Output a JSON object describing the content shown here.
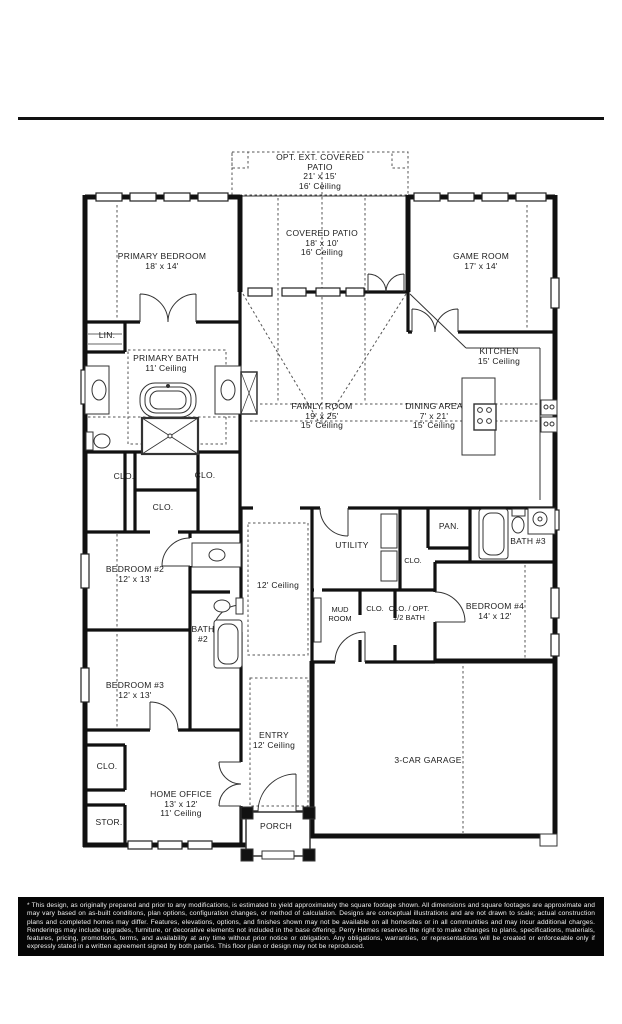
{
  "colors": {
    "wall": "#111111",
    "thin_line": "#333333",
    "dashed_line": "#555555",
    "disclaimer_bg": "#000000",
    "disclaimer_text": "#f2f2f2"
  },
  "plan": {
    "labels": {
      "opt_patio": {
        "lines": [
          "OPT. EXT. COVERED",
          "PATIO",
          "21' x 15'",
          "16' Ceiling"
        ]
      },
      "covered_patio": {
        "lines": [
          "COVERED PATIO",
          "18' x 10'",
          "16' Ceiling"
        ]
      },
      "primary_bedroom": {
        "lines": [
          "PRIMARY BEDROOM",
          "18' x 14'"
        ]
      },
      "game_room": {
        "lines": [
          "GAME ROOM",
          "17' x 14'"
        ]
      },
      "kitchen": {
        "lines": [
          "KITCHEN",
          "15' Ceiling"
        ]
      },
      "family_room": {
        "lines": [
          "FAMILY ROOM",
          "19' x 25'",
          "15' Ceiling"
        ]
      },
      "dining_area": {
        "lines": [
          "DINING AREA",
          "7' x 21'",
          "15' Ceiling"
        ]
      },
      "primary_bath": {
        "lines": [
          "PRIMARY BATH",
          "11' Ceiling"
        ]
      },
      "lin": {
        "lines": [
          "LIN."
        ]
      },
      "clo_a": {
        "lines": [
          "CLO."
        ]
      },
      "clo_b": {
        "lines": [
          "CLO."
        ]
      },
      "clo_c": {
        "lines": [
          "CLO."
        ]
      },
      "bedroom2": {
        "lines": [
          "BEDROOM #2",
          "12' x 13'"
        ]
      },
      "bath2": {
        "lines": [
          "BATH",
          "#2"
        ]
      },
      "bedroom3": {
        "lines": [
          "BEDROOM #3",
          "12' x 13'"
        ]
      },
      "hall_ceiling": {
        "lines": [
          "12' Ceiling"
        ]
      },
      "utility": {
        "lines": [
          "UTILITY"
        ]
      },
      "pan": {
        "lines": [
          "PAN."
        ]
      },
      "clo_d": {
        "lines": [
          "CLO."
        ]
      },
      "bath3": {
        "lines": [
          "BATH #3"
        ]
      },
      "mud_room": {
        "lines": [
          "MUD",
          "ROOM"
        ]
      },
      "clo_e": {
        "lines": [
          "CLO."
        ]
      },
      "clo_opt_bath": {
        "lines": [
          "CLO. / OPT.",
          "1/2 BATH"
        ]
      },
      "bedroom4": {
        "lines": [
          "BEDROOM #4",
          "14' x 12'"
        ]
      },
      "entry": {
        "lines": [
          "ENTRY",
          "12' Ceiling"
        ]
      },
      "garage": {
        "lines": [
          "3-CAR GARAGE"
        ]
      },
      "clo_f": {
        "lines": [
          "CLO."
        ]
      },
      "home_office": {
        "lines": [
          "HOME OFFICE",
          "13' x 12'",
          "11' Ceiling"
        ]
      },
      "stor": {
        "lines": [
          "STOR."
        ]
      },
      "porch": {
        "lines": [
          "PORCH"
        ]
      }
    }
  },
  "disclaimer": {
    "text": "* This design, as originally prepared and prior to any modifications, is estimated to  yield approximately the  square footage  shown.  All dimensions and  square footages are approximate and  may vary based  on as-built conditions,  plan options,  configuration changes,  or method of  calculation.  Designs are  conceptual  illustrations and  are not drawn to scale; actual construction plans and completed homes may differ.   Features,  elevations,  options,  and finishes shown may not be available on all homesites or in all communities and may incur additional charges.   Renderings may include upgrades, furniture, or decorative elements not included in the base offering. Perry Homes reserves the  right to  make  changes  to plans,  specifications,  materials,  features,  pricing,  promotions,  terms,  and  availability  at any time without  prior  notice  or  obligation.  Any obligations, warranties, or representations will be created or enforceable only if expressly stated in a written agreement signed by both parties. This floor plan or design may not be reproduced."
  }
}
